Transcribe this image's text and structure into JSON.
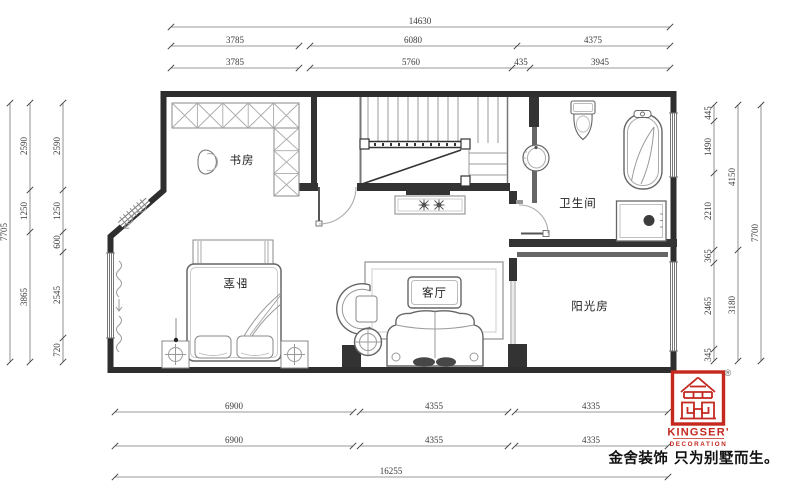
{
  "rooms": {
    "study": "书房",
    "bedroom": "卧室",
    "living": "客厅",
    "bathroom": "卫生间",
    "sunroom": "阳光房"
  },
  "dimensions": {
    "top": [
      [
        "14630"
      ],
      [
        "3785",
        "6080",
        "4375"
      ],
      [
        "3785",
        "5760",
        "435",
        "3945"
      ]
    ],
    "bottom": [
      [
        "6900",
        "4355",
        "4335"
      ],
      [
        "6900",
        "4355",
        "4335"
      ],
      [
        "16255"
      ]
    ],
    "left": [
      [
        "7705"
      ],
      [
        "2590",
        "1250",
        "3865"
      ],
      [
        "2590",
        "1250",
        "600",
        "2545",
        "720"
      ]
    ],
    "right": [
      [
        "445",
        "1490",
        "2210",
        "365",
        "2465",
        "345"
      ],
      [
        "4150",
        "3180"
      ],
      [
        "7700"
      ]
    ]
  },
  "logo": {
    "brand": "KINGSER'",
    "sub": "DECORATION",
    "registered": "®",
    "tagline": "金舍装饰 只为别墅而生。",
    "red": "#c4281f"
  }
}
